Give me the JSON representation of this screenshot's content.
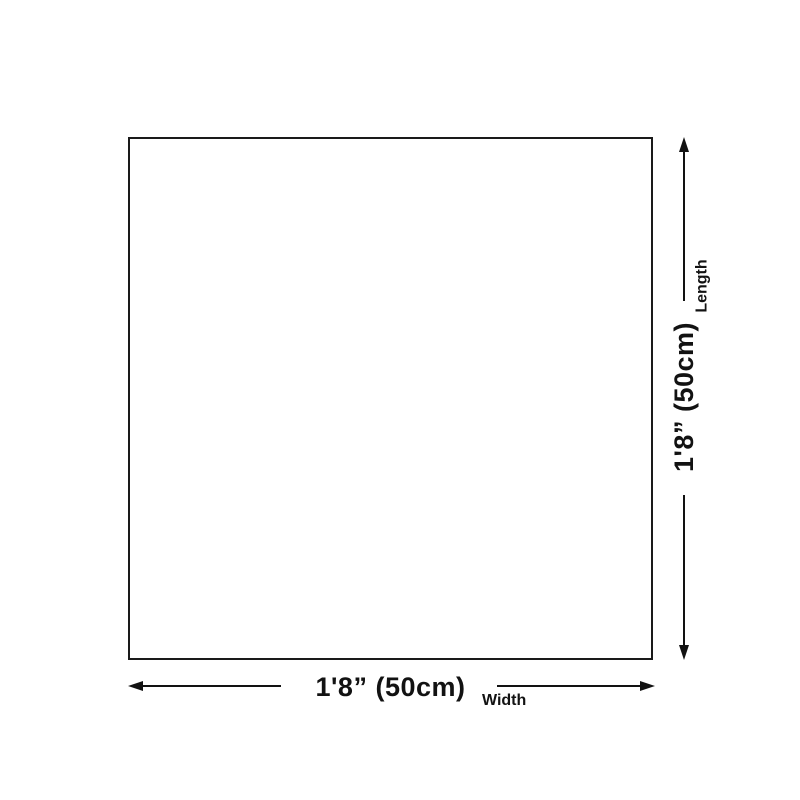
{
  "diagram": {
    "type": "product-dimension-diagram",
    "shape": "square-outline",
    "colors": {
      "background": "#ffffff",
      "outline": "#1a1a1a",
      "line": "#121212",
      "text": "#121212"
    },
    "dimensions": {
      "width": {
        "value": "1'8” (50cm)",
        "label": "Width"
      },
      "length": {
        "value": "1'8” (50cm)",
        "label": "Length"
      }
    }
  }
}
